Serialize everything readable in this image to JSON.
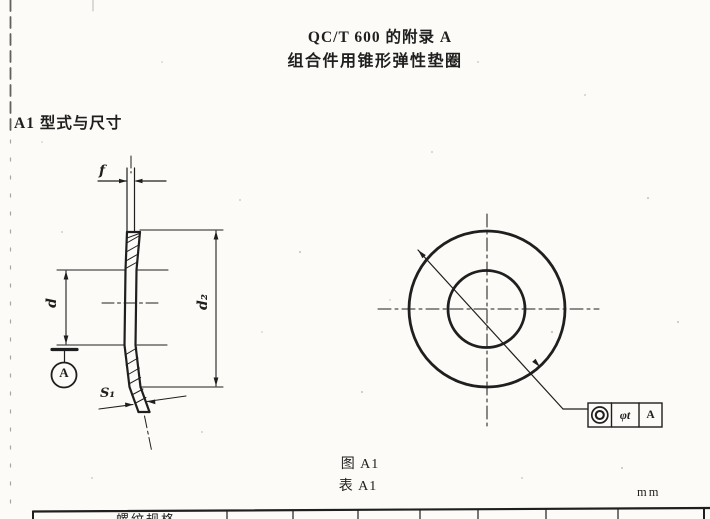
{
  "document": {
    "title_line1": "QC/T 600 的附录 A",
    "title_line2": "组合件用锥形弹性垫圈",
    "section_heading": "A1  型式与尺寸",
    "figure_caption": "图 A1",
    "table_caption": "表 A1",
    "unit_label": "mm",
    "table_partial_header": "螺纹规格"
  },
  "figure": {
    "section_view": {
      "dim_f": "f",
      "dim_d": "d",
      "dim_d2": "d₂",
      "dim_s1": "S₁",
      "datum_label": "A"
    },
    "front_view": {
      "tolerance_frame": {
        "symbol": "concentricity",
        "tolerance": "φt",
        "datum": "A"
      }
    }
  },
  "colors": {
    "ink": "#1f1f1f",
    "paper": "#fcfbf7"
  }
}
